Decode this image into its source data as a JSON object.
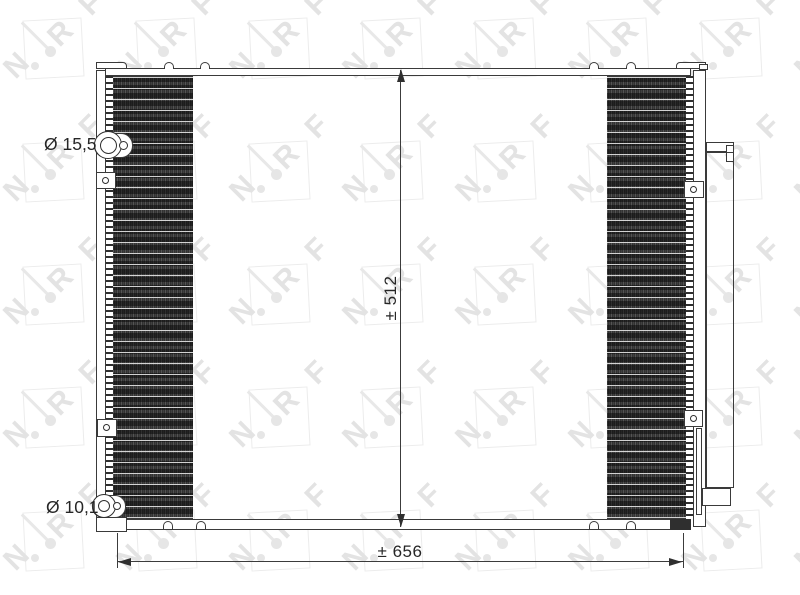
{
  "watermark": {
    "letters": [
      "N",
      "R",
      "F"
    ]
  },
  "dimensions": {
    "top_port_diameter": "Ø 15,5",
    "bottom_port_diameter": "Ø 10,1",
    "height": "± 512",
    "width": "± 656"
  },
  "colors": {
    "line": "#3a3a3a",
    "hatch": "#323232",
    "watermark_gray": "#e3e3e3",
    "label_text": "#262626"
  }
}
